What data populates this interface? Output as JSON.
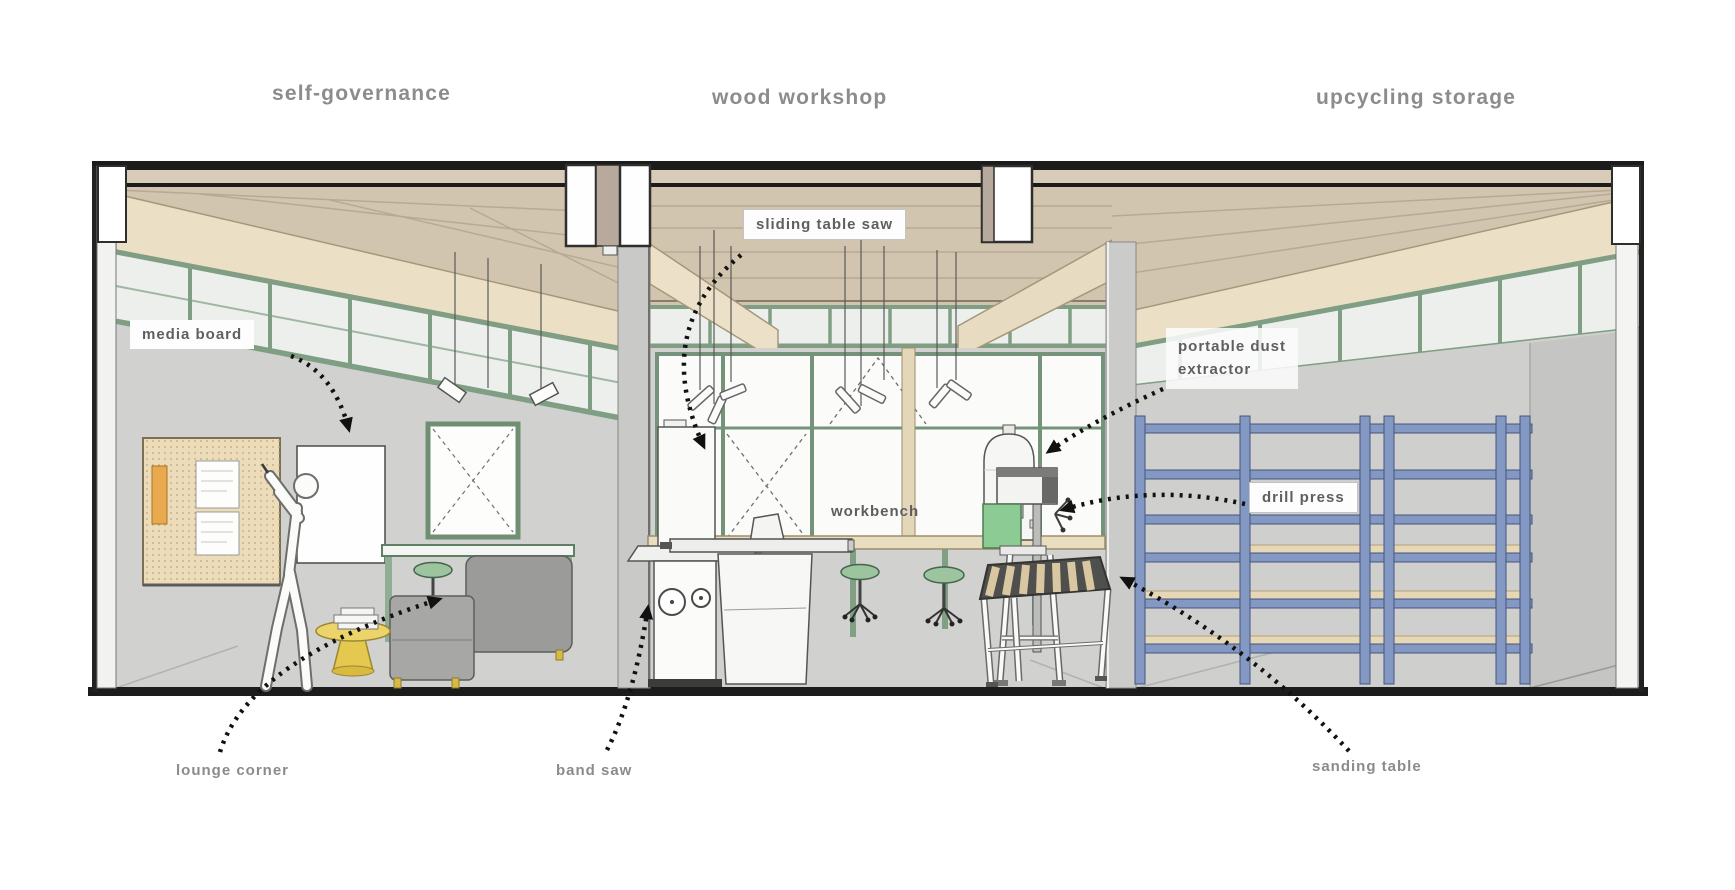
{
  "page": {
    "background": "#ffffff"
  },
  "section_titles": [
    {
      "label": "self-governance"
    },
    {
      "label": "wood workshop"
    },
    {
      "label": "upcycling storage"
    }
  ],
  "callouts": {
    "media_board": "media board",
    "sliding_table_saw": "sliding table saw",
    "portable_dust_extractor_line1": "portable dust",
    "portable_dust_extractor_line2": "extractor",
    "drill_press": "drill press",
    "workbench": "workbench",
    "lounge_corner": "lounge corner",
    "band_saw": "band saw",
    "sanding_table": "sanding table"
  },
  "colors": {
    "title_text": "#8c8c8c",
    "callout_text": "#5f5f5f",
    "caption_text": "#8b8b8b",
    "structure_black": "#1c1c1c",
    "ceiling_wood": "#d2c5b0",
    "beam_cream": "#ebe0c6",
    "window_frame_green": "#7f9e84",
    "wall_gray": "#d1d1cf",
    "shelving_blue": "#8398c2",
    "shelf_board_tan": "#e6d8b6",
    "table_yellow": "#ecd36a",
    "stool_green": "#9cc49e",
    "drill_press_green": "#8ccb93",
    "arrow_black": "#111111"
  }
}
